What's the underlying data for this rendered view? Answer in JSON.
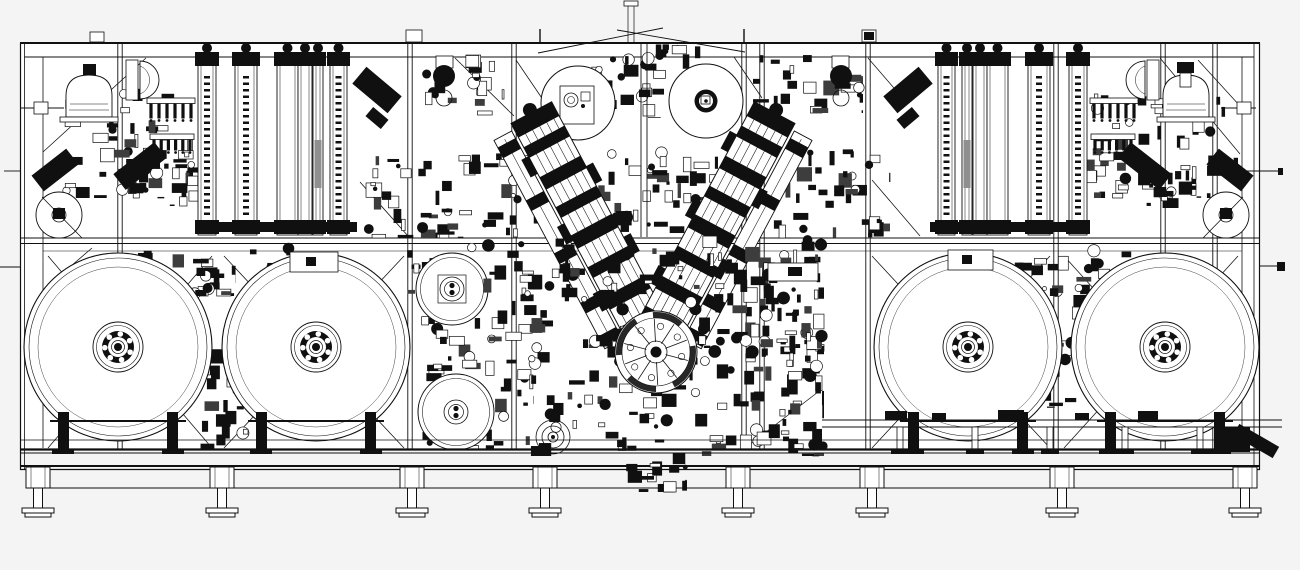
{
  "colors": {
    "background": "#f4f4f4",
    "paper": "#ffffff",
    "ink": "#101010",
    "gray": "#8f8f8f",
    "midgray": "#3d3d3d"
  },
  "canvas": {
    "w": 1300,
    "h": 570
  },
  "frame": {
    "x": 20,
    "y": 43,
    "w": 1240,
    "h": 406,
    "top2": 57,
    "mid1": 238,
    "mid2": 243.5,
    "mid3": 251,
    "baseLines": [
      440,
      449.5,
      453,
      466,
      469.5,
      488
    ],
    "leftInner": 43,
    "rightInner": 1242,
    "outerL2": 24.5,
    "outerR2": 1254
  },
  "posts": [
    120,
    410,
    514,
    744,
    762,
    868,
    1056,
    1163,
    1215
  ],
  "braces": [
    [
      43,
      152,
      146,
      58
    ],
    [
      43,
      290,
      92,
      248
    ],
    [
      455,
      58,
      514,
      116
    ],
    [
      516,
      60,
      550,
      110
    ],
    [
      734,
      57,
      762,
      98
    ],
    [
      868,
      58,
      906,
      102
    ],
    [
      360,
      182,
      408,
      236
    ],
    [
      872,
      180,
      920,
      236
    ],
    [
      1160,
      58,
      1240,
      154
    ],
    [
      1198,
      60,
      1240,
      106
    ],
    [
      48,
      256,
      212,
      448
    ],
    [
      48,
      448,
      212,
      256
    ],
    [
      224,
      256,
      404,
      448
    ],
    [
      224,
      448,
      404,
      256
    ],
    [
      872,
      256,
      1050,
      448
    ],
    [
      872,
      448,
      1050,
      256
    ],
    [
      1064,
      256,
      1238,
      448
    ],
    [
      1064,
      448,
      1238,
      256
    ],
    [
      748,
      446,
      818,
      392
    ]
  ],
  "lifting": {
    "xlines": [
      [
        538,
        53,
        663,
        28
      ],
      [
        617,
        30,
        745,
        52
      ]
    ],
    "stubs": [
      540,
      744
    ],
    "mast": [
      628,
      634
    ],
    "cap": [
      624,
      1,
      14,
      5
    ]
  },
  "columns": {
    "top": 58,
    "h": 177,
    "left": [
      [
        198,
        18,
        1
      ],
      [
        235,
        22,
        1
      ],
      [
        277,
        21,
        0
      ],
      [
        298,
        14,
        0
      ],
      [
        313,
        10,
        2
      ],
      [
        330,
        17,
        1
      ]
    ],
    "right": [
      [
        938,
        17,
        1
      ],
      [
        962,
        10,
        2
      ],
      [
        973,
        14,
        0
      ],
      [
        987,
        21,
        0
      ],
      [
        1028,
        22,
        1
      ],
      [
        1069,
        18,
        1
      ]
    ],
    "bars": [
      [
        195,
        222,
        162,
        10
      ],
      [
        930,
        222,
        160,
        10
      ]
    ],
    "rails": [
      [
        195,
        360
      ],
      [
        930,
        1090
      ]
    ]
  },
  "combs": [
    [
      147,
      98,
      48,
      24
    ],
    [
      150,
      134,
      44,
      20
    ],
    [
      1090,
      98,
      48,
      24
    ],
    [
      1091,
      134,
      44,
      20
    ]
  ],
  "bells": [
    [
      89,
      117,
      46,
      42
    ],
    [
      1186,
      117,
      46,
      42
    ]
  ],
  "ddomes": [
    {
      "plate": [
        126,
        60,
        12,
        40
      ],
      "cx": 140,
      "y1": 61,
      "y2": 99,
      "sweep": 1
    },
    {
      "plate": [
        1147,
        60,
        12,
        40
      ],
      "cx": 1145,
      "y1": 61,
      "y2": 99,
      "sweep": 0
    }
  ],
  "side_rollers": [
    {
      "c": [
        59,
        215
      ],
      "r": 23,
      "line": [
        42,
        197,
        82,
        238
      ],
      "hub": [
        53,
        208,
        12,
        11
      ]
    },
    {
      "c": [
        1226,
        215
      ],
      "r": 23,
      "line": [
        1243,
        197,
        1203,
        238
      ],
      "hub": [
        1220,
        208,
        12,
        11
      ]
    }
  ],
  "reels_large": {
    "centers": [
      [
        118,
        347
      ],
      [
        316,
        347
      ],
      [
        968,
        347
      ],
      [
        1165,
        347
      ]
    ],
    "radii": [
      94,
      89,
      80
    ],
    "hub": {
      "rings": [
        25,
        21.5
      ],
      "band": 16,
      "inner": 10,
      "bolts": 7,
      "boltR": 2.8,
      "boltRad": 13.2,
      "core": 6.5,
      "dot": 4
    }
  },
  "reels_medium": [
    {
      "c": [
        452,
        289
      ],
      "r": 36,
      "style": "plate"
    },
    {
      "c": [
        456,
        412
      ],
      "r": 38,
      "style": "rings"
    }
  ],
  "reels_top": [
    {
      "c": [
        578,
        103
      ],
      "r": 37,
      "style": "plate"
    },
    {
      "c": [
        706,
        101
      ],
      "r": 37,
      "style": "hub"
    }
  ],
  "varms": {
    "len": 250,
    "w": 46,
    "left": {
      "cx": 590,
      "cy": 223,
      "rot": -28,
      "mirror": 0
    },
    "right": {
      "cx": 716,
      "cy": 223,
      "rot": 28,
      "mirror": 1
    },
    "blocks": [
      [
        -125,
        16
      ],
      [
        -98,
        12
      ],
      [
        -64,
        14
      ],
      [
        -30,
        12
      ],
      [
        2,
        15
      ],
      [
        38,
        12
      ],
      [
        72,
        14
      ],
      [
        106,
        19
      ]
    ],
    "tabs": [
      [
        -31,
        -88
      ],
      [
        23,
        -52
      ],
      [
        -31,
        -12
      ],
      [
        23,
        28
      ],
      [
        -31,
        64
      ]
    ],
    "sblocks": [
      [
        -110,
        12
      ],
      [
        -50,
        12
      ],
      [
        10,
        12
      ],
      [
        66,
        12
      ],
      [
        104,
        12
      ]
    ]
  },
  "turret": {
    "c": [
      656,
      352
    ],
    "r": 41,
    "spokes": 10
  },
  "conveyor": {
    "y1": 420,
    "y2": 427,
    "x1": 822,
    "x2": 1282,
    "stands": [
      900,
      975,
      1050,
      1125,
      1200
    ],
    "blobs": [
      [
        885,
        411,
        22,
        9
      ],
      [
        998,
        410,
        26,
        10
      ],
      [
        1138,
        411,
        20,
        9
      ],
      [
        932,
        413,
        14,
        7
      ],
      [
        1075,
        413,
        14,
        7
      ]
    ],
    "end_block": [
      1214,
      427,
      36,
      25
    ]
  },
  "feet": {
    "xs": [
      38,
      222,
      412,
      545,
      738,
      872,
      1062,
      1245
    ]
  },
  "clusters": [
    {
      "name": "left-machinery-upper",
      "x": 58,
      "y": 88,
      "w": 135,
      "h": 110,
      "n": 52,
      "z": 1
    },
    {
      "name": "left-machinery-lower",
      "x": 118,
      "y": 148,
      "w": 80,
      "h": 58,
      "n": 20,
      "z": 1
    },
    {
      "name": "left-row-west",
      "x": 88,
      "y": 246,
      "w": 148,
      "h": 50,
      "n": 36,
      "z": 1
    },
    {
      "name": "left-row-east",
      "x": 235,
      "y": 248,
      "w": 108,
      "h": 42,
      "n": 24,
      "z": 1
    },
    {
      "name": "pre-center-left",
      "x": 366,
      "y": 150,
      "w": 72,
      "h": 88,
      "n": 22,
      "z": 1
    },
    {
      "name": "center-left-process",
      "x": 420,
      "y": 148,
      "w": 118,
      "h": 90,
      "n": 36,
      "z": 1
    },
    {
      "name": "top-head",
      "x": 590,
      "y": 44,
      "w": 122,
      "h": 74,
      "n": 42,
      "z": 1
    },
    {
      "name": "top-right-rollers",
      "x": 745,
      "y": 55,
      "w": 118,
      "h": 58,
      "n": 24,
      "z": 1
    },
    {
      "name": "top-left-of-reel",
      "x": 424,
      "y": 55,
      "w": 80,
      "h": 60,
      "n": 20,
      "z": 1
    },
    {
      "name": "left-of-medium-reel",
      "x": 406,
      "y": 242,
      "w": 76,
      "h": 88,
      "n": 20,
      "z": 1
    },
    {
      "name": "center-right-process",
      "x": 772,
      "y": 148,
      "w": 118,
      "h": 90,
      "n": 36,
      "z": 1
    },
    {
      "name": "right-row",
      "x": 945,
      "y": 248,
      "w": 200,
      "h": 48,
      "n": 36,
      "z": 1
    },
    {
      "name": "right-machinery-upper",
      "x": 1078,
      "y": 88,
      "w": 160,
      "h": 110,
      "n": 48,
      "z": 1
    },
    {
      "name": "right-machinery-lower",
      "x": 1118,
      "y": 150,
      "w": 78,
      "h": 58,
      "n": 18,
      "z": 1
    },
    {
      "name": "left-reel-post-unit",
      "x": 190,
      "y": 332,
      "w": 58,
      "h": 118,
      "n": 26,
      "z": 1
    },
    {
      "name": "right-reel-post-unit",
      "x": 1028,
      "y": 288,
      "w": 66,
      "h": 120,
      "n": 28,
      "z": 1
    },
    {
      "name": "center-right-column",
      "x": 742,
      "y": 244,
      "w": 82,
      "h": 212,
      "n": 60,
      "z": 1
    },
    {
      "name": "center-left-lower",
      "x": 416,
      "y": 320,
      "w": 118,
      "h": 130,
      "n": 42,
      "z": 2
    },
    {
      "name": "between-arms",
      "x": 592,
      "y": 152,
      "w": 126,
      "h": 86,
      "n": 44,
      "z": 3
    },
    {
      "name": "central-upper-blob",
      "x": 482,
      "y": 236,
      "w": 336,
      "h": 112,
      "n": 115,
      "z": 4
    },
    {
      "name": "central-lower-blob",
      "x": 530,
      "y": 330,
      "w": 292,
      "h": 126,
      "n": 100,
      "z": 4
    },
    {
      "name": "under-base-unit",
      "x": 625,
      "y": 452,
      "w": 62,
      "h": 40,
      "n": 16,
      "z": 5
    }
  ],
  "extras": {
    "lines": [
      [
        641,
        43,
        641,
        237
      ],
      [
        647,
        43,
        647,
        237
      ],
      [
        0,
        267,
        20,
        267
      ],
      [
        1260,
        266,
        1278,
        266
      ],
      [
        1226,
        171,
        1280,
        171
      ],
      [
        4,
        171,
        20,
        171
      ],
      [
        20,
        108,
        64,
        108
      ],
      [
        1221,
        108,
        1256,
        108
      ]
    ],
    "rects_stroke": [
      [
        406,
        30,
        16,
        12
      ],
      [
        862,
        30,
        14,
        12
      ],
      [
        90,
        32,
        14,
        10
      ],
      [
        436,
        56,
        17,
        12
      ],
      [
        832,
        56,
        17,
        12
      ],
      [
        34,
        102,
        14,
        12
      ],
      [
        1237,
        102,
        14,
        12
      ],
      [
        290,
        252,
        48,
        20
      ],
      [
        948,
        250,
        45,
        20
      ],
      [
        768,
        263,
        50,
        18
      ],
      [
        1180,
        73,
        11,
        14
      ]
    ],
    "rects_fill": [
      [
        1277,
        262,
        8,
        9
      ],
      [
        1278,
        168,
        5,
        7
      ],
      [
        864,
        32,
        10,
        8
      ],
      [
        83,
        64,
        13,
        11
      ],
      [
        1177,
        62,
        17,
        11
      ],
      [
        306,
        257,
        10,
        9
      ],
      [
        962,
        255,
        10,
        9
      ],
      [
        788,
        267,
        14,
        9
      ]
    ],
    "circles_fill": [
      [
        444,
        76,
        11
      ],
      [
        841,
        76,
        11
      ],
      [
        553,
        437,
        2
      ]
    ],
    "circles_stroke": [
      [
        444,
        98,
        8
      ],
      [
        841,
        98,
        8
      ],
      [
        553,
        437,
        17
      ],
      [
        553,
        437,
        11
      ],
      [
        553,
        437,
        5
      ]
    ],
    "rot_rects": [
      [
        377,
        90,
        46,
        22,
        40
      ],
      [
        908,
        90,
        46,
        22,
        -40
      ],
      [
        55,
        170,
        44,
        20,
        -38
      ],
      [
        1230,
        170,
        44,
        20,
        38
      ],
      [
        140,
        166,
        52,
        20,
        -38
      ],
      [
        1145,
        166,
        52,
        20,
        38
      ],
      [
        1256,
        441,
        46,
        13,
        30
      ],
      [
        377,
        118,
        20,
        12,
        40
      ],
      [
        908,
        118,
        20,
        12,
        -40
      ]
    ]
  }
}
